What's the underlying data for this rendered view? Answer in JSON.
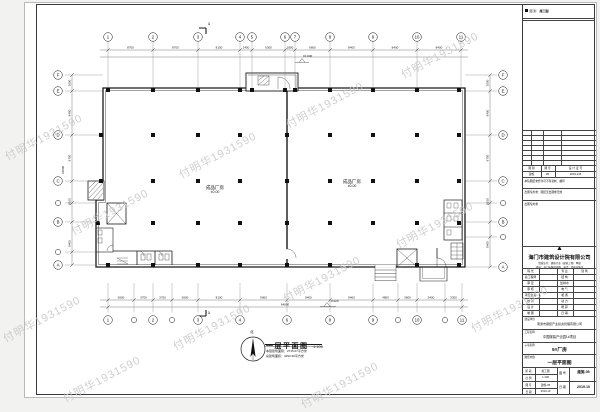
{
  "colors": {
    "line": "#1a1a1a",
    "dim": "#444444",
    "watermark": "#c7c7c7",
    "paper": "#ffffff",
    "background": "#f2f2f0"
  },
  "watermark": {
    "text": "付明华1931590"
  },
  "plan": {
    "title": "一层平面图",
    "scale": "1:100",
    "note1": "本层建筑面积：2715.07平方米",
    "note2": "总建筑面积：4293.39平方米",
    "north_label": "北",
    "room_left_name": "成品厂房",
    "room_left_elev": "±0.00",
    "room_right_name": "成品厂房",
    "room_right_elev": "±0.00",
    "elev_top": "±0.000",
    "elev_bottom": "-0.020",
    "section_mark": "1",
    "grid_top": [
      "1",
      "2",
      "3",
      "4",
      "5",
      "6",
      "7",
      "8",
      "9",
      "10",
      "11"
    ],
    "grid_bottom": [
      "1",
      "",
      "2",
      "",
      "3",
      "4",
      "6",
      "8",
      "9",
      "",
      "10",
      "",
      "11"
    ],
    "grid_left": [
      "F",
      "E",
      "D",
      "C",
      "B",
      "A"
    ],
    "grid_right": [
      "F",
      "E",
      "D",
      "C",
      "B",
      "A"
    ],
    "dims_top": [
      "8700",
      "8700",
      "8100",
      "2400",
      "6300",
      "1800",
      "6600",
      "8400",
      "8400",
      "8400"
    ],
    "dims_bottom": [
      "5000",
      "3700",
      "3700",
      "5000",
      "8100",
      "9000",
      "8400",
      "8400",
      "4800",
      "3600",
      "5400",
      "3300"
    ],
    "dims_left": [
      "3000",
      "8400",
      "8700",
      "8100",
      "8400"
    ],
    "dims_right": [
      "3000",
      "8400",
      "8700",
      "8100",
      "8400"
    ],
    "total_bottom": "64800",
    "total_left": "34800"
  },
  "titleblock": {
    "stage_label": "图 别",
    "stage_value": "施工图",
    "doc_header": [
      "图 别",
      "图 号",
      "设 计 证 号"
    ],
    "doc_values": [
      "建施",
      "05",
      "2019-116"
    ],
    "note1": "本院图纸未经许可不得复制、翻印",
    "note2": "出图专用章：图纸无出图章无效",
    "stamp_label": "出图专用章",
    "logo_glyph": "▲",
    "company_name": "海门市建筑设计院有限公司",
    "company_line1": "资质证书：建筑行业（建筑工程）甲级",
    "company_line2": "地址：海门市解放中路　电话：0513-8221",
    "sign_rows": [
      [
        "院 长",
        "",
        "专 业",
        "建 筑"
      ],
      [
        "总工程师",
        "",
        "结 构",
        ""
      ],
      [
        "审 定",
        "",
        "给排水",
        ""
      ],
      [
        "审 核",
        "",
        "电 气",
        ""
      ],
      [
        "项目负责",
        "",
        "暖 通",
        ""
      ],
      [
        "校 对",
        "",
        "动 力",
        ""
      ],
      [
        "设 计",
        "",
        "概 算",
        ""
      ],
      [
        "制 图",
        "",
        "日 期",
        ""
      ]
    ],
    "project_rows": [
      [
        "建设单位",
        "南通市服装产业投资管理有限公司"
      ],
      [
        "工程名称",
        "中国服装产业园1#项目"
      ],
      [
        "子项名称",
        "5#厂房"
      ],
      [
        "图纸内容",
        "一层平面图"
      ]
    ],
    "bottom_left_rows": [
      [
        "阶 段",
        "施工图"
      ],
      [
        "比 例",
        "1:100"
      ],
      [
        "图 号",
        "建施-05"
      ],
      [
        "日 期",
        "2019.10"
      ]
    ],
    "bottom_right": {
      "label1": "图 号",
      "value1": "建施-05",
      "label2": "日 期",
      "value2": "2019.10"
    }
  }
}
